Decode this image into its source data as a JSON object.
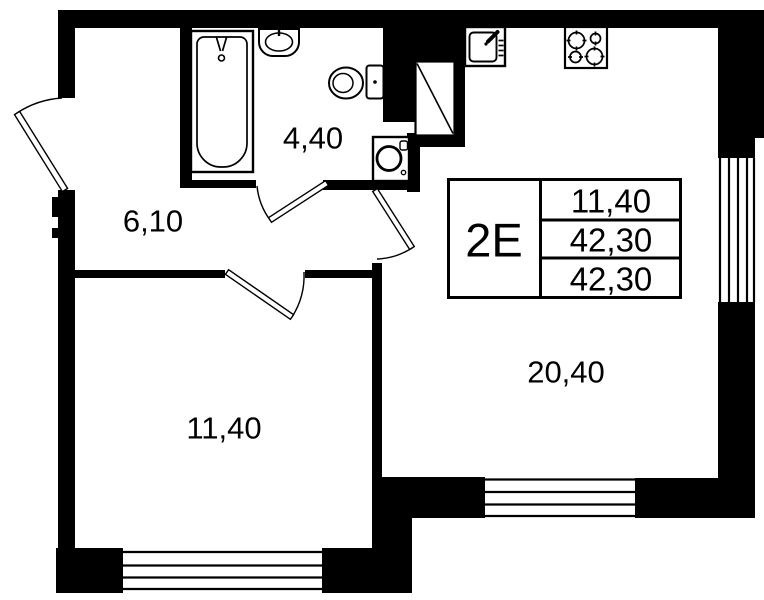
{
  "plan": {
    "type": "apartment-floor-plan",
    "unit_code": "2Е",
    "rooms": [
      {
        "id": "hallway",
        "area_label": "6,10"
      },
      {
        "id": "bathroom",
        "area_label": "4,40"
      },
      {
        "id": "bedroom",
        "area_label": "11,40"
      },
      {
        "id": "living-kitchen",
        "area_label": "20,40"
      }
    ],
    "info_table": {
      "unit_label": "2Е",
      "living_area": "11,40",
      "total_area": "42,30",
      "total_area_with_balcony": "42,30"
    },
    "fixtures": [
      "bathtub",
      "wash-basin",
      "toilet",
      "washing-machine",
      "kitchen-sink",
      "stove",
      "ventilation-shaft"
    ],
    "windows": [
      "bedroom-window",
      "living-room-window",
      "right-side-window"
    ],
    "doors": [
      "entrance-door",
      "bathroom-door",
      "living-room-door",
      "bedroom-door"
    ],
    "colors": {
      "line": "#000000",
      "background": "#ffffff"
    }
  }
}
